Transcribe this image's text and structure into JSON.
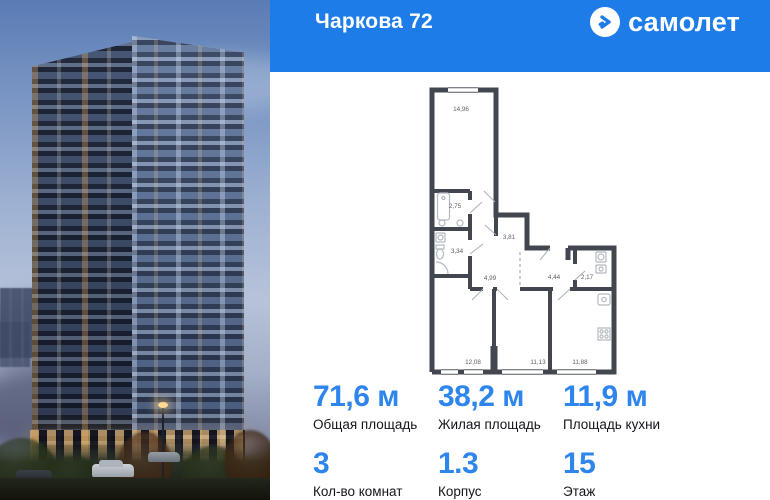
{
  "header": {
    "title": "Чаркова 72",
    "brand": "самолет"
  },
  "floorplan": {
    "rooms": [
      {
        "name": "living-room",
        "area": "14,96"
      },
      {
        "name": "bathroom",
        "area": "2,75"
      },
      {
        "name": "wc",
        "area": "3,34"
      },
      {
        "name": "hallway",
        "area": "3,81"
      },
      {
        "name": "corridor",
        "area": "4,99"
      },
      {
        "name": "hall",
        "area": "4,44"
      },
      {
        "name": "washroom",
        "area": "2,17"
      },
      {
        "name": "bedroom-1",
        "area": "12,08"
      },
      {
        "name": "bedroom-2",
        "area": "11,13"
      },
      {
        "name": "kitchen",
        "area": "11,88"
      }
    ]
  },
  "stats": {
    "areas": [
      {
        "value": "71,6 м",
        "label": "Общая площадь"
      },
      {
        "value": "38,2 м",
        "label": "Жилая площадь"
      },
      {
        "value": "11,9 м",
        "label": "Площадь кухни"
      }
    ],
    "details": [
      {
        "value": "3",
        "label": "Кол-во комнат"
      },
      {
        "value": "1.3",
        "label": "Корпус"
      },
      {
        "value": "15",
        "label": "Этаж"
      }
    ]
  },
  "colors": {
    "header_blue": "#1e7ce9",
    "accent_blue": "#2e86ec",
    "wall_gray": "#42474f",
    "text_dark": "#14151b"
  }
}
